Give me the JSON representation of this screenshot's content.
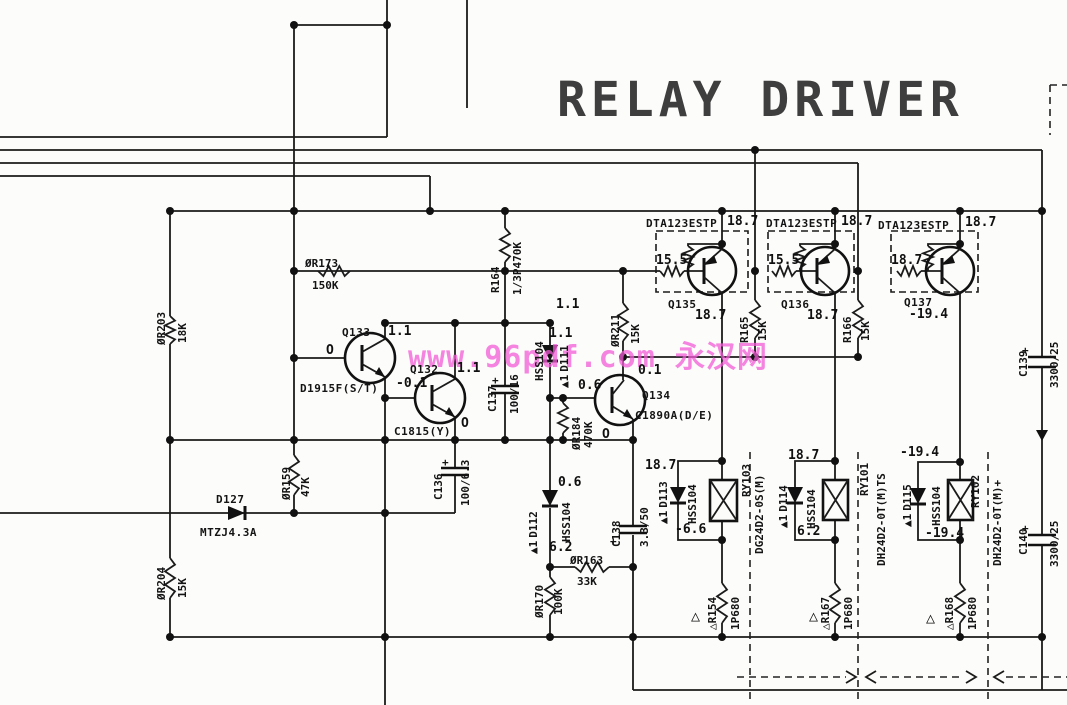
{
  "title": "RELAY DRIVER",
  "watermark": {
    "text": "www.96pdf.com 永汉网",
    "color": "#f25cd6"
  },
  "polarity_mark": "+",
  "warning_triangle": "△",
  "test_points": [
    "O",
    "O",
    "O"
  ],
  "components": {
    "transistors": [
      {
        "ref": "Q133",
        "part": "D1915F(S/T)"
      },
      {
        "ref": "Q132",
        "part": "C1815(Y)"
      },
      {
        "ref": "Q134",
        "part": "C1890A(D/E)"
      },
      {
        "ref": "Q135",
        "part": "DTA123ESTP",
        "internal_r": "15.5",
        "rail_v": "18.7",
        "out_v": "18.7"
      },
      {
        "ref": "Q136",
        "part": "DTA123ESTP",
        "internal_r": "15.5",
        "rail_v": "18.7",
        "out_v": "18.7"
      },
      {
        "ref": "Q137",
        "part": "DTA123ESTP",
        "internal_r": "18.7",
        "rail_v": "18.7",
        "out_v": "-19.4"
      }
    ],
    "resistors": [
      {
        "ref": "ØR203",
        "value": "18K"
      },
      {
        "ref": "ØR204",
        "value": "15K"
      },
      {
        "ref": "ØR173",
        "value": "150K"
      },
      {
        "ref": "ØR159",
        "value": "47K"
      },
      {
        "ref": "R164",
        "value": "1/3P470K"
      },
      {
        "ref": "ØR211",
        "value": "15K"
      },
      {
        "ref": "ØR184",
        "value": "470K"
      },
      {
        "ref": "ØR163",
        "value": "33K"
      },
      {
        "ref": "ØR170",
        "value": "100K"
      },
      {
        "ref": "R165",
        "value": "15K"
      },
      {
        "ref": "R166",
        "value": "15K"
      },
      {
        "ref": "△R154",
        "value": "1P680"
      },
      {
        "ref": "△R167",
        "value": "1P680"
      },
      {
        "ref": "△R168",
        "value": "1P680"
      }
    ],
    "capacitors": [
      {
        "ref": "C137",
        "value": "100/16"
      },
      {
        "ref": "C136",
        "value": "100/6.3"
      },
      {
        "ref": "C138",
        "value": "3.3/50"
      },
      {
        "ref": "C139",
        "value": "3300/25"
      },
      {
        "ref": "C140",
        "value": "3300/25"
      }
    ],
    "diodes": [
      {
        "ref": "D127",
        "part": "MTZJ4.3A"
      },
      {
        "ref": "D111",
        "part": "HSS104",
        "mark": "▲1"
      },
      {
        "ref": "D112",
        "part": "HSS104",
        "mark": "▲1"
      },
      {
        "ref": "D113",
        "part": "HSS104",
        "mark": "▲1"
      },
      {
        "ref": "D114",
        "part": "HSS104",
        "mark": "▲1"
      },
      {
        "ref": "D115",
        "part": "HSS104",
        "mark": "▲1"
      }
    ],
    "relays": [
      {
        "ref": "RY103",
        "part": "DG24D2-0S(M)"
      },
      {
        "ref": "RY101",
        "part": "DH24D2-0T(M)TS"
      },
      {
        "ref": "RY102",
        "part": "DH24D2-0T(M)+"
      }
    ]
  },
  "voltages": [
    "1.1",
    "1.1",
    "1.1",
    "1.1",
    "-0.1",
    "0.6",
    "0.1",
    "0.6",
    "6.2",
    "18.7",
    "-6.6",
    "18.7",
    "6.2",
    "-19.4",
    "-19.4"
  ]
}
